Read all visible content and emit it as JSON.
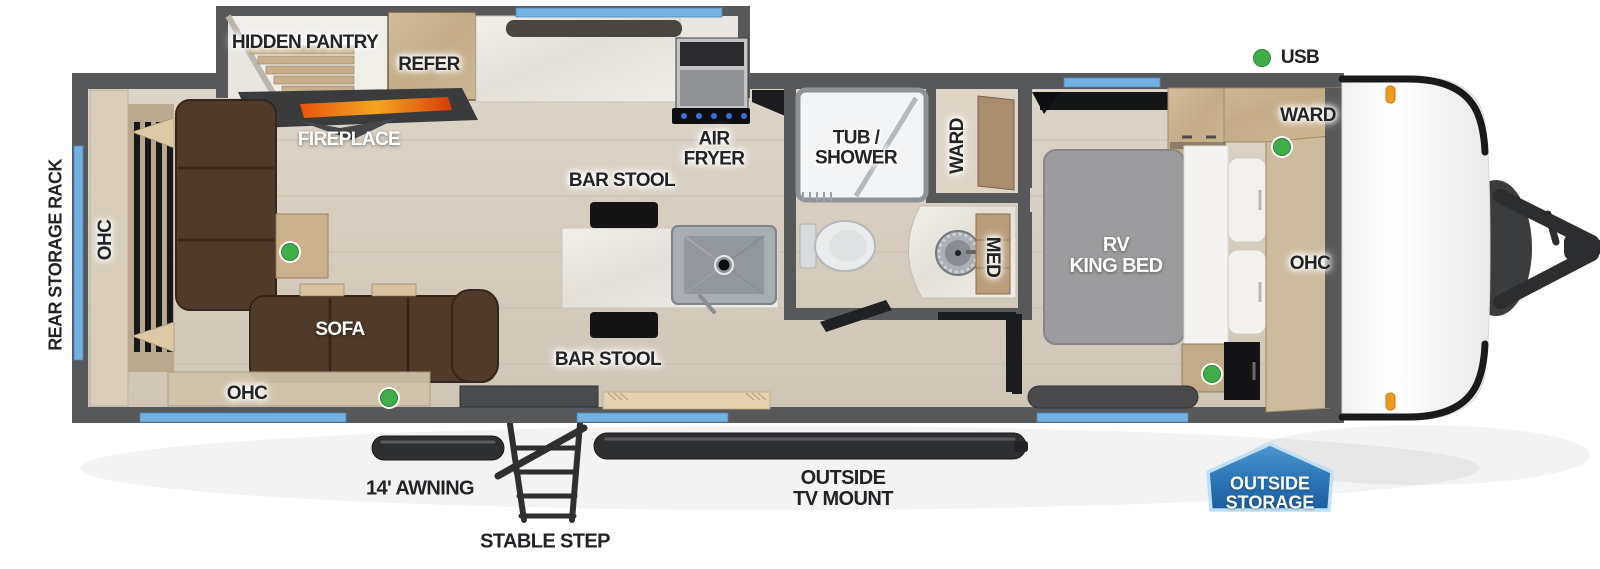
{
  "title": "Travel trailer floorplan",
  "colors": {
    "wall_gray": "#57585a",
    "floor_wood": "#d9d0c3",
    "window_blue": "#74b2e2",
    "led_green": "#3fae49",
    "sofa_brown": "#503a2a",
    "cabinet_wood": "#c9b596",
    "badge_blue": "#2d79b8",
    "marker_orange": "#f09a1c"
  },
  "exterior": {
    "rear_storage_rack": "REAR STORAGE RACK",
    "usb": "USB",
    "awning": "14' AWNING",
    "stable_step": "STABLE STEP",
    "outside_tv_mount": "OUTSIDE\nTV MOUNT",
    "outside_storage": "OUTSIDE\nSTORAGE"
  },
  "living": {
    "ohc_rear": "OHC",
    "sofa": "SOFA",
    "ohc_lower": "OHC",
    "fireplace": "FIREPLACE"
  },
  "kitchen": {
    "hidden_pantry": "HIDDEN PANTRY",
    "refer": "REFER",
    "air_fryer": "AIR\nFRYER",
    "bar_stool_top": "BAR STOOL",
    "bar_stool_bottom": "BAR STOOL"
  },
  "bathroom": {
    "tub_shower": "TUB /\nSHOWER",
    "ward": "WARD",
    "med": "MED"
  },
  "bedroom": {
    "bed": "RV\nKING BED",
    "ward": "WARD",
    "ohc": "OHC"
  },
  "indicators": {
    "led_count": 5,
    "led_color": "#3fae49"
  }
}
